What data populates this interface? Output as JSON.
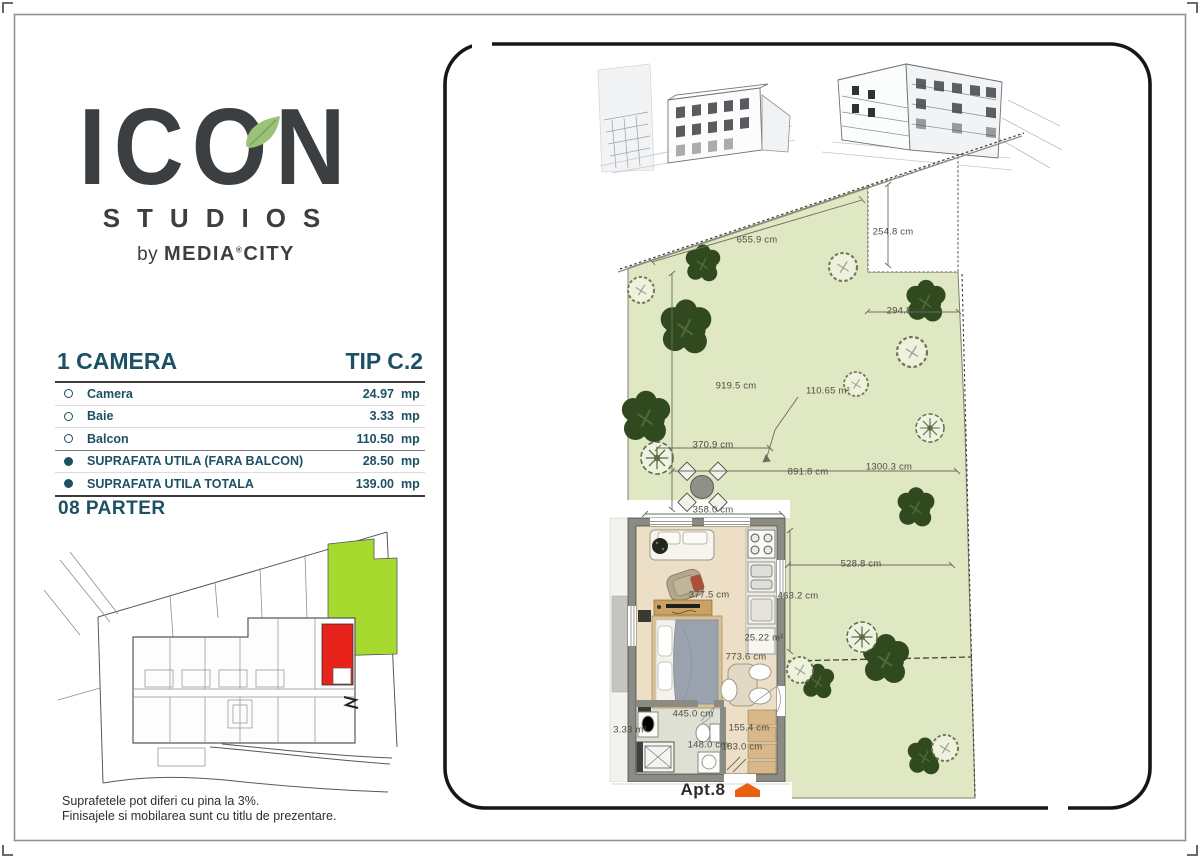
{
  "logo": {
    "brand": "ICON",
    "sub": "STUDIOS",
    "by_prefix": "by",
    "by_name_left": "MEDIA",
    "by_mark": "®",
    "by_name_right": "CITY",
    "leaf_color": "#9cc178",
    "text_color": "#3b3f42"
  },
  "spec": {
    "title_left": "1 CAMERA",
    "title_right": "TIP C.2",
    "accent_color": "#1c5163",
    "rows": [
      {
        "bullet": "open",
        "label": "Camera",
        "value": "24.97",
        "unit": "mp"
      },
      {
        "bullet": "open",
        "label": "Baie",
        "value": "3.33",
        "unit": "mp"
      },
      {
        "bullet": "open",
        "label": "Balcon",
        "value": "110.50",
        "unit": "mp"
      },
      {
        "bullet": "filled",
        "label": "SUPRAFATA UTILA (FARA BALCON)",
        "value": "28.50",
        "unit": "mp"
      },
      {
        "bullet": "filled",
        "label": "SUPRAFATA UTILA TOTALA",
        "value": "139.00",
        "unit": "mp"
      }
    ]
  },
  "floor_label": "08 PARTER",
  "disclaimer": {
    "line1": "Suprafetele pot diferi cu pina la 3%.",
    "line2": "Finisajele si mobilarea sunt cu titlu de prezentare."
  },
  "site_map": {
    "highlighted_unit_color": "#e8231b",
    "garden_patch_color": "#a6da2f"
  },
  "plan": {
    "apt_label": "Apt.8",
    "marker_color": "#e8610f",
    "garden_fill": "#dfe7c3",
    "areas": {
      "garden": "110.65 m²",
      "room": "25.22 m²",
      "bath": "3.33 m²"
    },
    "dims": {
      "d655": "655.9 cm",
      "d254": "254.8 cm",
      "d294": "294.8 cm",
      "d919": "919.5 cm",
      "d370": "370.9 cm",
      "d891": "891.8 cm",
      "d1300": "1300.3 cm",
      "d358": "358.0 cm",
      "d528": "528.8 cm",
      "d463": "463.2 cm",
      "d377": "377.5 cm",
      "d773": "773.6 cm",
      "d445": "445.0 cm",
      "d155": "155.4 cm",
      "d148": "148.0 cm",
      "d183": "183.0 cm"
    }
  }
}
